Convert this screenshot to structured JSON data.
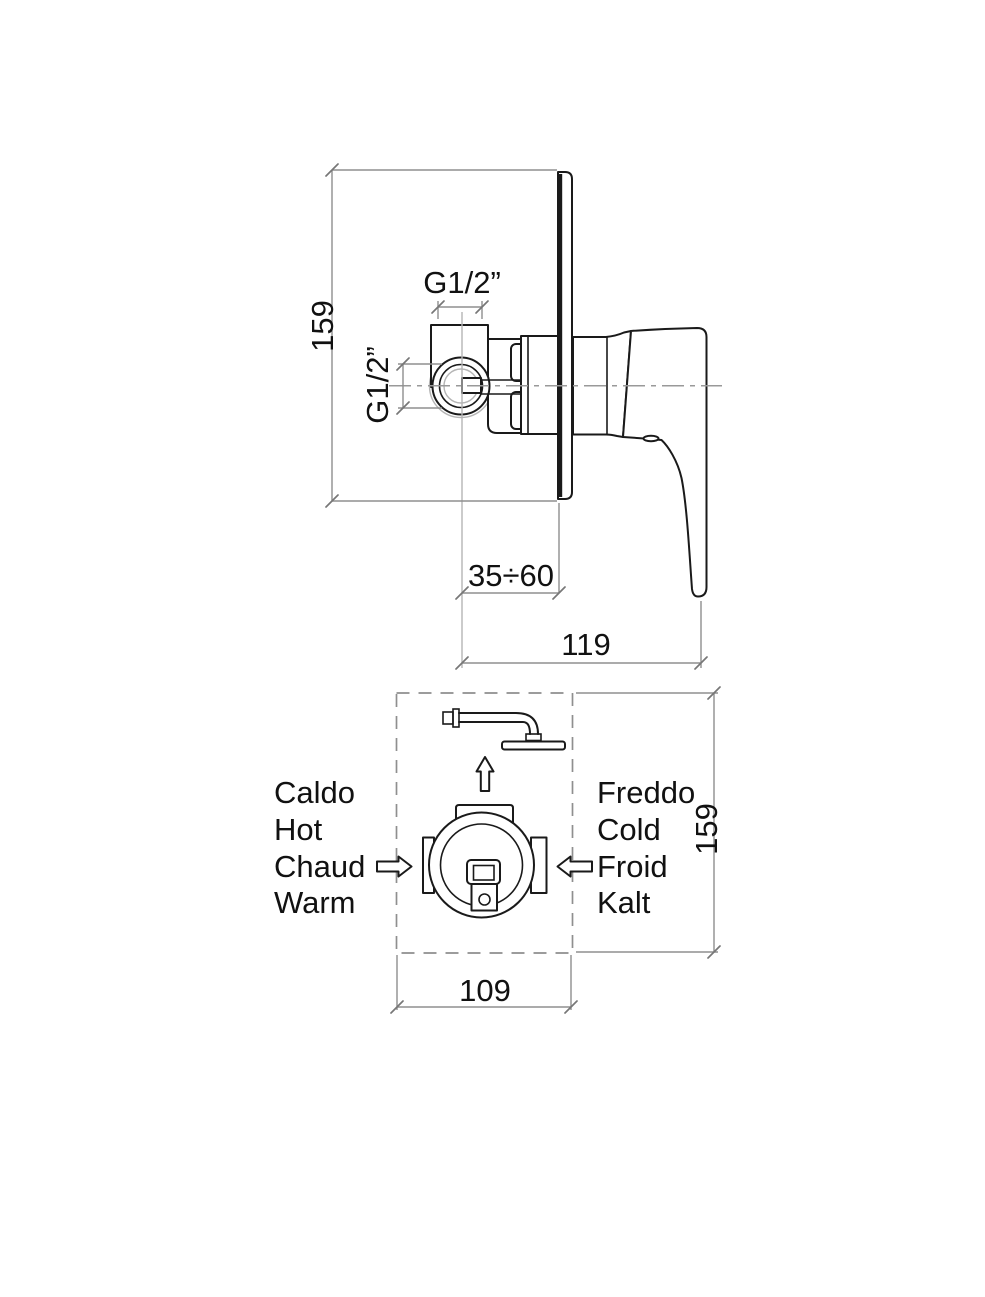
{
  "side_view": {
    "height_dim": "159",
    "top_port_dim": "G1/2”",
    "side_port_dim": "G1/2”",
    "depth_range_dim": "35÷60",
    "total_depth_dim": "119"
  },
  "front_view": {
    "width_dim": "109",
    "height_dim": "159",
    "hot_labels": [
      "Caldo",
      "Hot",
      "Chaud",
      "Warm"
    ],
    "cold_labels": [
      "Freddo",
      "Cold",
      "Froid",
      "Kalt"
    ]
  },
  "colors": {
    "line": "#1a1a1a",
    "dimension": "#8f8f8f",
    "construction": "#b5b5b5"
  }
}
